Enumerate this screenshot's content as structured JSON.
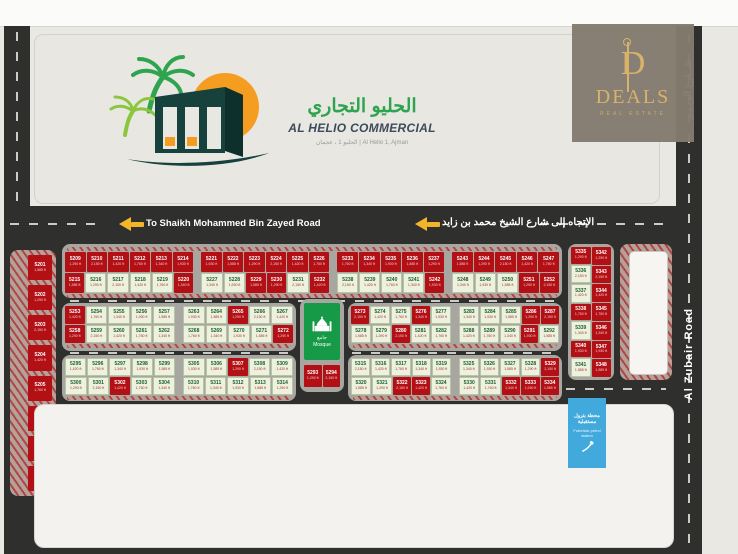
{
  "logo": {
    "title_ar": "الحليو التجاري",
    "title_en": "AL HELIO COMMERCIAL",
    "subtitle": "الحليو 1 ، عجمان  |  Al Helio 1, Ajman"
  },
  "deals": {
    "initial": "D",
    "name": "DEALS",
    "tagline": "REAL ESTATE"
  },
  "roads": {
    "top_en": "To Shaikh Mohammed Bin Zayed Road",
    "top_ar": "الإتجاه إلى شارع الشيخ محمد بن زايد",
    "right_en": "Al Zubair Road",
    "right_ar": "شــارع الزبـيـر"
  },
  "mosque": {
    "label_ar": "جامع",
    "label_en": "Mosque"
  },
  "petrol_station": {
    "label_ar": "محطة بترول مستقبلية",
    "label_en": "Futuristic petrol station"
  },
  "legend": {
    "items": [
      {
        "key": "under-construction",
        "color": "#edf2df",
        "label_ar": "مكاتب تجارية قيد البناء",
        "label_en": "Commercial Buildings under construction"
      },
      {
        "key": "petrol-station",
        "color": "#42a9dc",
        "label_ar": "محطة بترول",
        "label_en": "Petrol Station"
      },
      {
        "key": "mosque",
        "color": "#169a47",
        "label_ar": "جامع",
        "label_en": "Mosque"
      },
      {
        "key": "sold",
        "color": "#a31319",
        "label_ar": "مباع",
        "label_en": "Sold"
      }
    ]
  },
  "key_box": {
    "number": "0000",
    "area": "000 M²",
    "price": "000 K",
    "labels": [
      {
        "ar": "رقم الأرض",
        "en": "Plot Number"
      },
      {
        "ar": "مساحة الأرض",
        "en": "Plot Area"
      },
      {
        "ar": "السعر",
        "en": "Price"
      }
    ]
  },
  "notes_mid": {
    "ar": [
      "بنــاء مسجــد",
      "تنفيذ أعمدة إنارة",
      "إصدار تراخيص البناء"
    ],
    "en": [
      "Construction of a mosque",
      "Implementation of light poles",
      "Issuance of building permits"
    ]
  },
  "notes_right": {
    "ar": [
      "تملك حر لجميع الجنسيات",
      "شامل رسوم التسجيل والتملك",
      "شوارع أسفلت"
    ],
    "en": [
      "Freehold For All Nationalities",
      "Fees Included",
      "Asphalt Street"
    ]
  },
  "footer": {
    "website": "www.alrasikhoon.ae",
    "permit": "Permit No (AJRE1242) تصريح رقم"
  },
  "colors": {
    "sold_red": "#b31016",
    "available_green": "#ecf2de",
    "mosque_green": "#169a47",
    "petrol_blue": "#42a9dc",
    "road_dark": "#2f2f2d",
    "arrow_yellow": "#f2b52a",
    "deals_gold": "#d8b26a",
    "logo_green": "#2ea44f",
    "logo_orange": "#f59d20"
  },
  "plots": {
    "statuses_key": {
      "s": "sold",
      "a": "available"
    },
    "areas_cycle": [
      "1,585 ft",
      "1,290 ft",
      "2,150 ft",
      "1,420 ft",
      "1,760 ft",
      "1,340 ft",
      "1,930 ft"
    ],
    "blocks": {
      "left_col": {
        "start": 5201,
        "statuses": "ssssssss"
      },
      "r1g1t": {
        "start": 5209,
        "statuses": "ssssss"
      },
      "r1g1b": {
        "start": 5215,
        "statuses": "saaaas"
      },
      "r1g2t": {
        "start": 5221,
        "statuses": "ssssss"
      },
      "r1g2b": {
        "start": 5227,
        "statuses": "aassas"
      },
      "r1g3t": {
        "start": 5233,
        "statuses": "sssss"
      },
      "r1g3b": {
        "start": 5238,
        "statuses": "aaaas"
      },
      "r1g4t": {
        "start": 5243,
        "statuses": "sssss"
      },
      "r1g4b": {
        "start": 5248,
        "statuses": "aaass"
      },
      "r2g1t": {
        "start": 5253,
        "statuses": "saaaa"
      },
      "r2g1b": {
        "start": 5258,
        "statuses": "saaaa"
      },
      "r2g2t": {
        "start": 5263,
        "statuses": "aasaa"
      },
      "r2g2b": {
        "start": 5268,
        "statuses": "aaaas"
      },
      "r2g3t": {
        "start": 5273,
        "statuses": "saasa"
      },
      "r2g3b": {
        "start": 5278,
        "statuses": "aasaa"
      },
      "r2g4t": {
        "start": 5283,
        "statuses": "aaass"
      },
      "r2g4b": {
        "start": 5288,
        "statuses": "aaasa"
      },
      "mosque_col": {
        "start": 5293,
        "statuses": "ss"
      },
      "r3g1t": {
        "start": 5295,
        "statuses": "aaaaa"
      },
      "r3g1b": {
        "start": 5300,
        "statuses": "aasaa"
      },
      "r3g2t": {
        "start": 5305,
        "statuses": "aasaa"
      },
      "r3g2b": {
        "start": 5310,
        "statuses": "aaaaa"
      },
      "r3g3t": {
        "start": 5315,
        "statuses": "aaaaa"
      },
      "r3g3b": {
        "start": 5320,
        "statuses": "aassa"
      },
      "r3g4t": {
        "start": 5325,
        "statuses": "aaaas"
      },
      "r3g4b": {
        "start": 5330,
        "statuses": "aasss"
      },
      "vcol1": {
        "start": 5335,
        "statuses": "saasasa"
      },
      "vcol2": {
        "start": 5342,
        "statuses": "sssssss"
      }
    }
  }
}
